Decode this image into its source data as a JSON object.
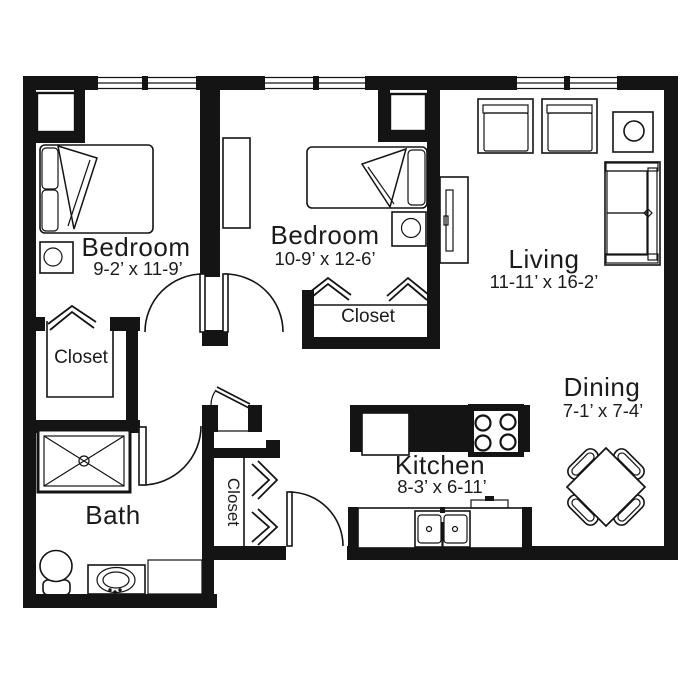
{
  "plan": {
    "colors": {
      "ink": "#141414",
      "floor": "#ffffff",
      "text": "#1b1b1b"
    },
    "rooms": {
      "bedroom1": {
        "label": "Bedroom",
        "dims": "9-2’ x 11-9’"
      },
      "bedroom2": {
        "label": "Bedroom",
        "dims": "10-9’ x 12-6’"
      },
      "living": {
        "label": "Living",
        "dims": "11-11’ x 16-2’"
      },
      "dining": {
        "label": "Dining",
        "dims": "7-1’ x 7-4’"
      },
      "kitchen": {
        "label": "Kitchen",
        "dims": "8-3’ x 6-11’"
      },
      "bath": {
        "label": "Bath"
      },
      "bedroom1_closet": {
        "label": "Closet"
      },
      "bedroom2_closet": {
        "label": "Closet"
      },
      "entry_closet": {
        "label": "Closet"
      }
    }
  }
}
